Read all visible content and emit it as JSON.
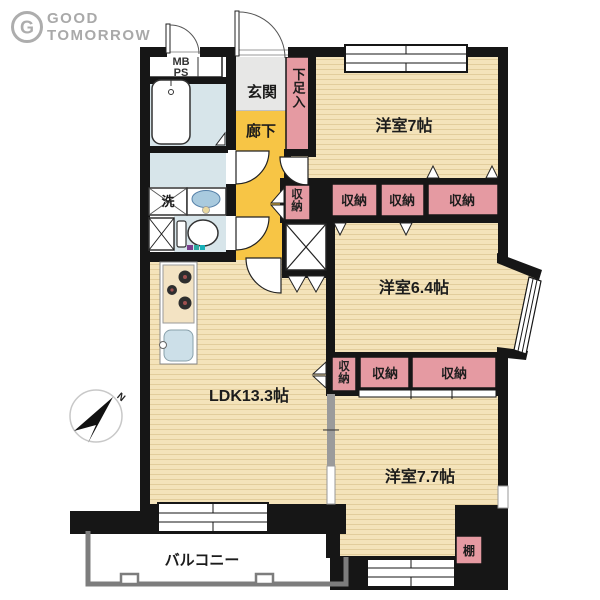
{
  "brand": {
    "monogram": "G",
    "line1": "GOOD",
    "line2": "TOMORROW"
  },
  "compass": {
    "north": "N"
  },
  "labels": {
    "mb": "MB",
    "ps": "PS",
    "entrance": "玄関",
    "shoe_storage": "下足入",
    "hallway": "廊下",
    "bedroom7": "洋室7帖",
    "bedroom64": "洋室6.4帖",
    "bedroom77": "洋室7.7帖",
    "ldk": "LDK13.3帖",
    "balcony": "バルコニー",
    "laundry": "洗",
    "shelf": "棚"
  },
  "closets": {
    "row1_vertical": "収納",
    "row1": [
      "収納",
      "収納",
      "収納"
    ],
    "row2_vertical": "収納",
    "row2": [
      "収納",
      "収納"
    ]
  },
  "colors": {
    "wall": "#161616",
    "wood_floor": "#f4e3ba",
    "wood_grain": "#e2cd9c",
    "closet_pink": "#e59aa2",
    "hallway_yellow": "#f7c545",
    "entrance_gray": "#e7e7e6",
    "wet_area_blue": "#d7e5ea",
    "balcony_gray": "#7d7d7d",
    "logo_gray": "#a9a9a9"
  }
}
